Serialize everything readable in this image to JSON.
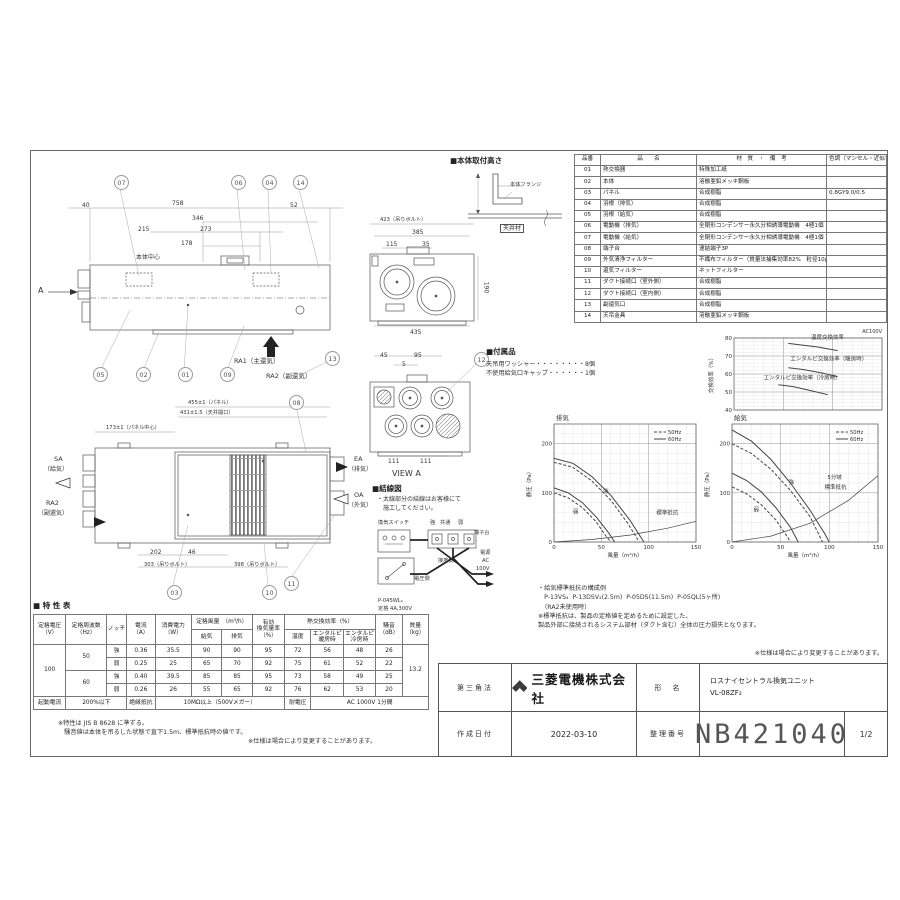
{
  "colors": {
    "line": "#555",
    "accent": "#b11116",
    "chart_line": "#444"
  },
  "parts_table": {
    "headers": [
      "品番",
      "品　　名",
      "材　質　・　備　考",
      "色調（マンセル・近似色）"
    ],
    "rows": [
      {
        "no": "01",
        "name": "熱交換器",
        "material": "特殊加工紙",
        "color": ""
      },
      {
        "no": "02",
        "name": "本体",
        "material": "溶融亜鉛メッキ鋼板",
        "color": ""
      },
      {
        "no": "03",
        "name": "パネル",
        "material": "合成樹脂",
        "color": "0.8GY9.0/0.5"
      },
      {
        "no": "04",
        "name": "羽根（排気）",
        "material": "合成樹脂",
        "color": ""
      },
      {
        "no": "05",
        "name": "羽根（給気）",
        "material": "合成樹脂",
        "color": ""
      },
      {
        "no": "06",
        "name": "電動機（排気）",
        "material": "全閉形コンデンサー永久分相誘導電動機　4極1個",
        "color": ""
      },
      {
        "no": "07",
        "name": "電動機（給気）",
        "material": "全閉形コンデンサー永久分相誘導電動機　4極1個",
        "color": ""
      },
      {
        "no": "08",
        "name": "端子台",
        "material": "速結端子3P",
        "color": ""
      },
      {
        "no": "09",
        "name": "外気清浄フィルター",
        "material": "不織布フィルター（質量法捕集効率82%　粒径10μm以上）",
        "color": ""
      },
      {
        "no": "10",
        "name": "還気フィルター",
        "material": "ネットフィルター",
        "color": ""
      },
      {
        "no": "11",
        "name": "ダクト接続口（室外側）",
        "material": "合成樹脂",
        "color": ""
      },
      {
        "no": "12",
        "name": "ダクト接続口（室内側）",
        "material": "合成樹脂",
        "color": ""
      },
      {
        "no": "13",
        "name": "副還気口",
        "material": "合成樹脂",
        "color": ""
      },
      {
        "no": "14",
        "name": "天吊金具",
        "material": "溶融亜鉛メッキ鋼板",
        "color": ""
      }
    ]
  },
  "mount": {
    "title": "■本体取付高さ",
    "labels": [
      {
        "t": "本体フランジ",
        "x": 62,
        "y": 26,
        "c": "tiny"
      },
      {
        "t": "天井材",
        "x": 52,
        "y": 68,
        "c": "boxed"
      }
    ]
  },
  "accessories": {
    "title": "■付属品",
    "items": [
      "天吊用ワッシャー・・・・・・・・8個",
      "不使用給気口キャップ・・・・・・1個"
    ]
  },
  "wiring": {
    "title": "■結線図",
    "note1": "・太線部分の結線はお客様にて",
    "note2": "　施工してください。",
    "labels": [
      {
        "t": "換気スイッチ",
        "x": 6,
        "y": 36,
        "c": "tiny"
      },
      {
        "t": "強",
        "x": 58,
        "y": 36,
        "c": "tiny"
      },
      {
        "t": "共通",
        "x": 68,
        "y": 36,
        "c": "tiny"
      },
      {
        "t": "弱",
        "x": 86,
        "y": 36,
        "c": "tiny"
      },
      {
        "t": "端子台",
        "x": 102,
        "y": 46,
        "c": "tiny"
      },
      {
        "t": "接地側",
        "x": 66,
        "y": 74,
        "c": "tiny"
      },
      {
        "t": "電圧側",
        "x": 42,
        "y": 92,
        "c": "tiny"
      },
      {
        "t": "電源",
        "x": 108,
        "y": 66,
        "c": "tiny"
      },
      {
        "t": "AC",
        "x": 110,
        "y": 74,
        "c": "tiny"
      },
      {
        "t": "100V",
        "x": 104,
        "y": 82,
        "c": "tiny"
      },
      {
        "t": "P-045WL₂",
        "x": 6,
        "y": 114,
        "c": "tiny"
      },
      {
        "t": "定格 4A,300V",
        "x": 6,
        "y": 122,
        "c": "tiny"
      }
    ]
  },
  "side_view": {
    "labels": [
      {
        "t": "40",
        "x": 44,
        "y": 32
      },
      {
        "t": "758",
        "x": 134,
        "y": 30
      },
      {
        "t": "52",
        "x": 252,
        "y": 32
      },
      {
        "t": "346",
        "x": 154,
        "y": 45
      },
      {
        "t": "215",
        "x": 100,
        "y": 56
      },
      {
        "t": "273",
        "x": 162,
        "y": 56
      },
      {
        "t": "178",
        "x": 143,
        "y": 70
      },
      {
        "t": "本体中心",
        "x": 98,
        "y": 84
      },
      {
        "t": "A",
        "x": 0,
        "y": 116,
        "c": "big"
      },
      {
        "t": "RA1（主還気）",
        "x": 196,
        "y": 188,
        "c": "med"
      },
      {
        "t": "RA2（副還気）",
        "x": 228,
        "y": 203,
        "c": "med"
      }
    ],
    "balloons": [
      {
        "n": "07",
        "x": 76,
        "y": 5
      },
      {
        "n": "06",
        "x": 193,
        "y": 5
      },
      {
        "n": "04",
        "x": 224,
        "y": 5
      },
      {
        "n": "14",
        "x": 255,
        "y": 5
      },
      {
        "n": "05",
        "x": 55,
        "y": 197
      },
      {
        "n": "02",
        "x": 98,
        "y": 197
      },
      {
        "n": "01",
        "x": 140,
        "y": 197
      },
      {
        "n": "09",
        "x": 182,
        "y": 197
      },
      {
        "n": "13",
        "x": 287,
        "y": 181
      }
    ]
  },
  "front_view": {
    "labels": [
      {
        "t": "423（吊りボルト）",
        "x": 28,
        "y": 1,
        "c": "tiny"
      },
      {
        "t": "385",
        "x": 60,
        "y": 13
      },
      {
        "t": "115",
        "x": 34,
        "y": 25
      },
      {
        "t": "35",
        "x": 70,
        "y": 25
      },
      {
        "t": "435",
        "x": 58,
        "y": 113
      },
      {
        "t": "190",
        "x": 128,
        "y": 68,
        "r": 90
      }
    ],
    "balloons": []
  },
  "view_a": {
    "labels": [
      {
        "t": "45",
        "x": 28,
        "y": 0
      },
      {
        "t": "95",
        "x": 62,
        "y": 0
      },
      {
        "t": "5",
        "x": 50,
        "y": 9
      },
      {
        "t": "111",
        "x": 36,
        "y": 106
      },
      {
        "t": "111",
        "x": 68,
        "y": 106
      },
      {
        "t": "VIEW A",
        "x": 40,
        "y": 117,
        "c": "big"
      }
    ],
    "balloons": [
      {
        "n": "12",
        "x": 122,
        "y": 0
      }
    ]
  },
  "plan_view": {
    "labels": [
      {
        "t": "455±1（パネル）",
        "x": 150,
        "y": 5,
        "c": "tiny"
      },
      {
        "t": "431±1.5（天井開口）",
        "x": 142,
        "y": 15,
        "c": "tiny"
      },
      {
        "t": "173±1（パネル中心）",
        "x": 68,
        "y": 30,
        "c": "tiny"
      },
      {
        "t": "SA",
        "x": 16,
        "y": 61,
        "c": "med"
      },
      {
        "t": "（給気）",
        "x": 6,
        "y": 71
      },
      {
        "t": "RA2",
        "x": 8,
        "y": 105,
        "c": "med"
      },
      {
        "t": "（副還気）",
        "x": 0,
        "y": 115
      },
      {
        "t": "EA",
        "x": 316,
        "y": 61,
        "c": "med"
      },
      {
        "t": "（排気）",
        "x": 310,
        "y": 71
      },
      {
        "t": "OA",
        "x": 316,
        "y": 97,
        "c": "med"
      },
      {
        "t": "（外気）",
        "x": 310,
        "y": 107
      },
      {
        "t": "202",
        "x": 112,
        "y": 154
      },
      {
        "t": "46",
        "x": 150,
        "y": 154
      },
      {
        "t": "303（吊りボルト）",
        "x": 106,
        "y": 167,
        "c": "tiny"
      },
      {
        "t": "398（吊りボルト）",
        "x": 196,
        "y": 167,
        "c": "tiny"
      }
    ],
    "balloons": [
      {
        "n": "08",
        "x": 251,
        "y": 0
      },
      {
        "n": "03",
        "x": 129,
        "y": 190
      },
      {
        "n": "10",
        "x": 224,
        "y": 190
      },
      {
        "n": "11",
        "x": 246,
        "y": 181
      }
    ]
  },
  "chart_data": [
    {
      "key": "exchange",
      "type": "line",
      "title": "AC100V",
      "ylabel": "交換効率（%）",
      "xlabel": "",
      "xlim": [
        0,
        150
      ],
      "ylim": [
        40,
        80
      ],
      "minor": [
        10,
        2
      ],
      "yticks": [
        40,
        50,
        60,
        70,
        80
      ],
      "xgrid": [
        50,
        100,
        150
      ],
      "series": [
        {
          "name": "温度交換効率",
          "points": [
            [
              55,
              77
            ],
            [
              70,
              76
            ],
            [
              85,
              75
            ],
            [
              105,
              73
            ]
          ]
        },
        {
          "name": "エンタルピ交換効率（暖房時）",
          "points": [
            [
              55,
              63.5
            ],
            [
              70,
              62.5
            ],
            [
              90,
              60.5
            ],
            [
              105,
              58.5
            ]
          ]
        },
        {
          "name": "エンタルピ交換効率（冷房時）",
          "points": [
            [
              45,
              54
            ],
            [
              60,
              53
            ],
            [
              80,
              50.5
            ],
            [
              95,
              48.5
            ]
          ]
        }
      ],
      "labels": [
        {
          "t": "温度交換効率",
          "x": 78,
          "y": 79.5
        },
        {
          "t": "エンタルピ交換効率（暖房時）",
          "x": 57,
          "y": 67.5
        },
        {
          "t": "エンタルピ交換効率（冷房時）",
          "x": 30,
          "y": 57
        }
      ]
    },
    {
      "key": "exhaust",
      "type": "line",
      "title": "排気",
      "ylabel": "静圧（Pa）",
      "xlabel": "風量（m³/h）",
      "xlim": [
        0,
        150
      ],
      "ylim": [
        0,
        240
      ],
      "minor": [
        10,
        20
      ],
      "yticks": [
        0,
        100,
        200
      ],
      "xticks": [
        0,
        50,
        100,
        150
      ],
      "legend": [
        "50Hz",
        "60Hz"
      ],
      "series": [
        {
          "name": "強 60Hz",
          "points": [
            [
              0,
              170
            ],
            [
              20,
              160
            ],
            [
              40,
              133
            ],
            [
              60,
              95
            ],
            [
              80,
              45
            ],
            [
              95,
              0
            ]
          ]
        },
        {
          "name": "強 50Hz",
          "dash": true,
          "points": [
            [
              0,
              162
            ],
            [
              20,
              152
            ],
            [
              40,
              124
            ],
            [
              60,
              85
            ],
            [
              78,
              38
            ],
            [
              90,
              0
            ]
          ]
        },
        {
          "name": "弱 60Hz",
          "points": [
            [
              0,
              110
            ],
            [
              15,
              100
            ],
            [
              30,
              80
            ],
            [
              45,
              50
            ],
            [
              58,
              18
            ],
            [
              64,
              0
            ]
          ]
        },
        {
          "name": "弱 50Hz",
          "dash": true,
          "points": [
            [
              0,
              100
            ],
            [
              15,
              90
            ],
            [
              30,
              70
            ],
            [
              44,
              42
            ],
            [
              55,
              12
            ],
            [
              60,
              0
            ]
          ]
        },
        {
          "name": "標準抵抗",
          "points": [
            [
              0,
              0
            ],
            [
              40,
              5
            ],
            [
              80,
              14
            ],
            [
              120,
              28
            ],
            [
              150,
              42
            ]
          ]
        }
      ],
      "labels": [
        {
          "t": "強",
          "x": 52,
          "y": 100
        },
        {
          "t": "弱",
          "x": 20,
          "y": 58
        },
        {
          "t": "標準抵抗",
          "x": 108,
          "y": 56
        }
      ]
    },
    {
      "key": "supply",
      "type": "line",
      "title": "給気",
      "ylabel": "静圧（Pa）",
      "xlabel": "風量（m³/h）",
      "xlim": [
        0,
        150
      ],
      "ylim": [
        0,
        240
      ],
      "minor": [
        10,
        20
      ],
      "yticks": [
        0,
        100,
        200
      ],
      "xticks": [
        0,
        50,
        100,
        150
      ],
      "legend": [
        "50Hz",
        "60Hz"
      ],
      "series": [
        {
          "name": "強 60Hz",
          "points": [
            [
              0,
              228
            ],
            [
              20,
              205
            ],
            [
              40,
              168
            ],
            [
              60,
              120
            ],
            [
              80,
              65
            ],
            [
              95,
              18
            ],
            [
              100,
              0
            ]
          ]
        },
        {
          "name": "強 50Hz",
          "dash": true,
          "points": [
            [
              0,
              200
            ],
            [
              20,
              180
            ],
            [
              40,
              148
            ],
            [
              60,
              105
            ],
            [
              80,
              52
            ],
            [
              93,
              0
            ]
          ]
        },
        {
          "name": "弱 60Hz",
          "points": [
            [
              0,
              140
            ],
            [
              15,
              125
            ],
            [
              30,
              102
            ],
            [
              45,
              70
            ],
            [
              60,
              30
            ],
            [
              68,
              0
            ]
          ]
        },
        {
          "name": "弱 50Hz",
          "dash": true,
          "points": [
            [
              0,
              112
            ],
            [
              15,
              98
            ],
            [
              30,
              76
            ],
            [
              45,
              45
            ],
            [
              57,
              10
            ],
            [
              60,
              0
            ]
          ]
        },
        {
          "name": "5分岐標準抵抗",
          "points": [
            [
              0,
              0
            ],
            [
              40,
              12
            ],
            [
              80,
              38
            ],
            [
              120,
              85
            ],
            [
              150,
              135
            ]
          ]
        }
      ],
      "labels": [
        {
          "t": "強",
          "x": 58,
          "y": 118
        },
        {
          "t": "弱",
          "x": 22,
          "y": 62
        },
        {
          "t": "5分岐",
          "x": 98,
          "y": 128
        },
        {
          "t": "標準抵抗",
          "x": 95,
          "y": 108
        }
      ]
    }
  ],
  "resistance_note": {
    "l1": "・給気標準抵抗の構成例",
    "l2": "　P-13VS₄  P-13DSV₂(2.5m)  P-05DS(11.5m)  P-05QL(5ヶ所)",
    "l3": "　（RA2未使用時）",
    "l4": "※標準抵抗は、製品の定格値を定めるために設定した、",
    "l5": "製品外部に接続されるシステム部材（ダクト含む）全体の圧力損失となります。",
    "note_right": "※仕様は場合により変更することがあります。"
  },
  "spec_table": {
    "title": "■ 特 性 表",
    "h": {
      "voltage": "定格電圧\n（V）",
      "freq": "定格周波数\n（Hz）",
      "notch": "ノッチ",
      "current": "電流\n（A）",
      "power": "消費電力\n（W）",
      "airflow": "定格風量　（m³/h）",
      "supply": "給気",
      "exhaust": "排気",
      "effective": "有効\n換気量率\n（%）",
      "hx": "熱交換効率（%）",
      "temp": "温度",
      "eh": "エンタルピ\n暖房時",
      "ec": "エンタルピ\n冷房時",
      "noise": "騒音\n（dB）",
      "mass": "質量\n（kg）"
    },
    "voltage": "100",
    "mass": "13.2",
    "rows": [
      {
        "freq": "50",
        "notch": "強",
        "current": "0.36",
        "power": "35.5",
        "sa": "90",
        "ea": "90",
        "eff": "95",
        "temp": "72",
        "eh": "56",
        "ec": "48",
        "noise": "26"
      },
      {
        "notch": "弱",
        "current": "0.25",
        "power": "25",
        "sa": "65",
        "ea": "70",
        "eff": "92",
        "temp": "75",
        "eh": "61",
        "ec": "52",
        "noise": "22"
      },
      {
        "freq": "60",
        "notch": "強",
        "current": "0.40",
        "power": "39.5",
        "sa": "85",
        "ea": "85",
        "eff": "95",
        "temp": "73",
        "eh": "58",
        "ec": "49",
        "noise": "25"
      },
      {
        "notch": "弱",
        "current": "0.26",
        "power": "26",
        "sa": "55",
        "ea": "65",
        "eff": "92",
        "temp": "76",
        "eh": "62",
        "ec": "53",
        "noise": "20"
      }
    ],
    "footer": {
      "start_label": "起動電流",
      "start": "200%以下",
      "ins_label": "絶縁抵抗",
      "ins": "10MΩ以上（500Vメガー）",
      "hv_label": "耐電圧",
      "hv": "AC 1000V 1分間"
    },
    "note1": "※特性は JIS B 8628 に準ずる。",
    "note2": "　騒音値は本体を吊るした状態で直下1.5m、標準抵抗時の値です。",
    "note_right": "※仕様は場合により変更することがあります。"
  },
  "title_block": {
    "projection": "第三角法",
    "company": "三菱電機株式会社",
    "model_label": "形　名",
    "model_line1": "ロスナイセントラル換気ユニット",
    "model_line2": "VL-08ZF₂",
    "date_label": "作成日付",
    "date": "2022-03-10",
    "number_label": "整理番号",
    "number": "NB421040",
    "page": "1/2"
  }
}
